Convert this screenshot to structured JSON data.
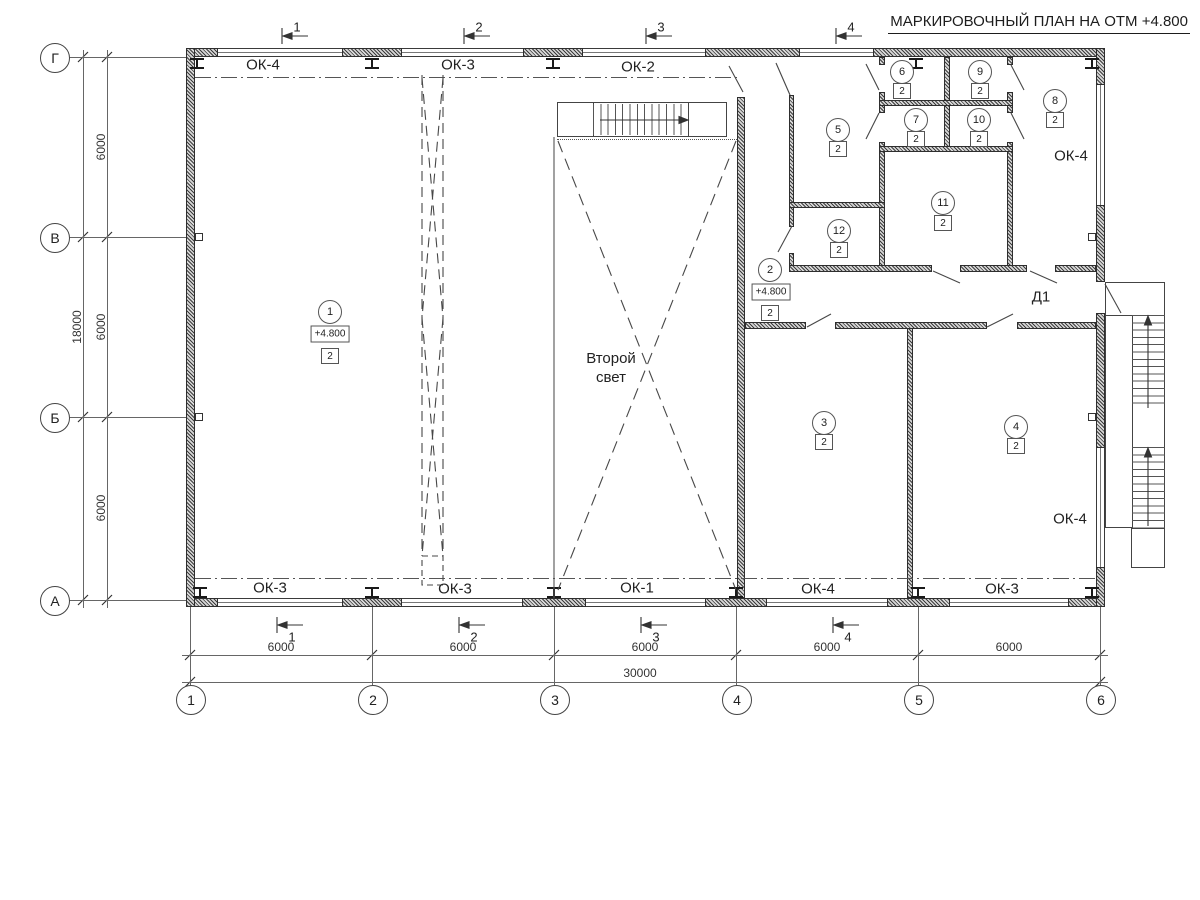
{
  "title": "МАРКИРОВОЧНЫЙ ПЛАН НА ОТМ +4.800",
  "grid": {
    "columns": [
      "1",
      "2",
      "3",
      "4",
      "5",
      "6"
    ],
    "rows": [
      "Г",
      "В",
      "Б",
      "А"
    ]
  },
  "dims": {
    "spans_bottom": [
      "6000",
      "6000",
      "6000",
      "6000",
      "6000"
    ],
    "total_bottom": "30000",
    "spans_left": [
      "6000",
      "6000",
      "6000"
    ],
    "total_left": "18000"
  },
  "sections": [
    "1",
    "2",
    "3",
    "4"
  ],
  "windows": {
    "top": [
      "ОК-4",
      "ОК-3",
      "ОК-2"
    ],
    "bottom": [
      "ОК-3",
      "ОК-3",
      "ОК-1",
      "ОК-4",
      "ОК-3"
    ],
    "right_upper": "ОК-4",
    "right_lower": "ОК-4"
  },
  "rooms": {
    "r1": {
      "num": "1",
      "level": "+4.800",
      "finish": "2"
    },
    "r2": {
      "num": "2",
      "level": "+4.800",
      "finish": "2"
    },
    "r3": {
      "num": "3",
      "finish": "2"
    },
    "r4": {
      "num": "4",
      "finish": "2"
    },
    "r5": {
      "num": "5",
      "finish": "2"
    },
    "r6": {
      "num": "6",
      "finish": "2"
    },
    "r7": {
      "num": "7",
      "finish": "2"
    },
    "r8": {
      "num": "8",
      "finish": "2"
    },
    "r9": {
      "num": "9",
      "finish": "2"
    },
    "r10": {
      "num": "10",
      "finish": "2"
    },
    "r11": {
      "num": "11",
      "finish": "2"
    },
    "r12": {
      "num": "12",
      "finish": "2"
    }
  },
  "annotations": {
    "second_light_1": "Второй",
    "second_light_2": "свет",
    "door_tag": "Д1"
  }
}
